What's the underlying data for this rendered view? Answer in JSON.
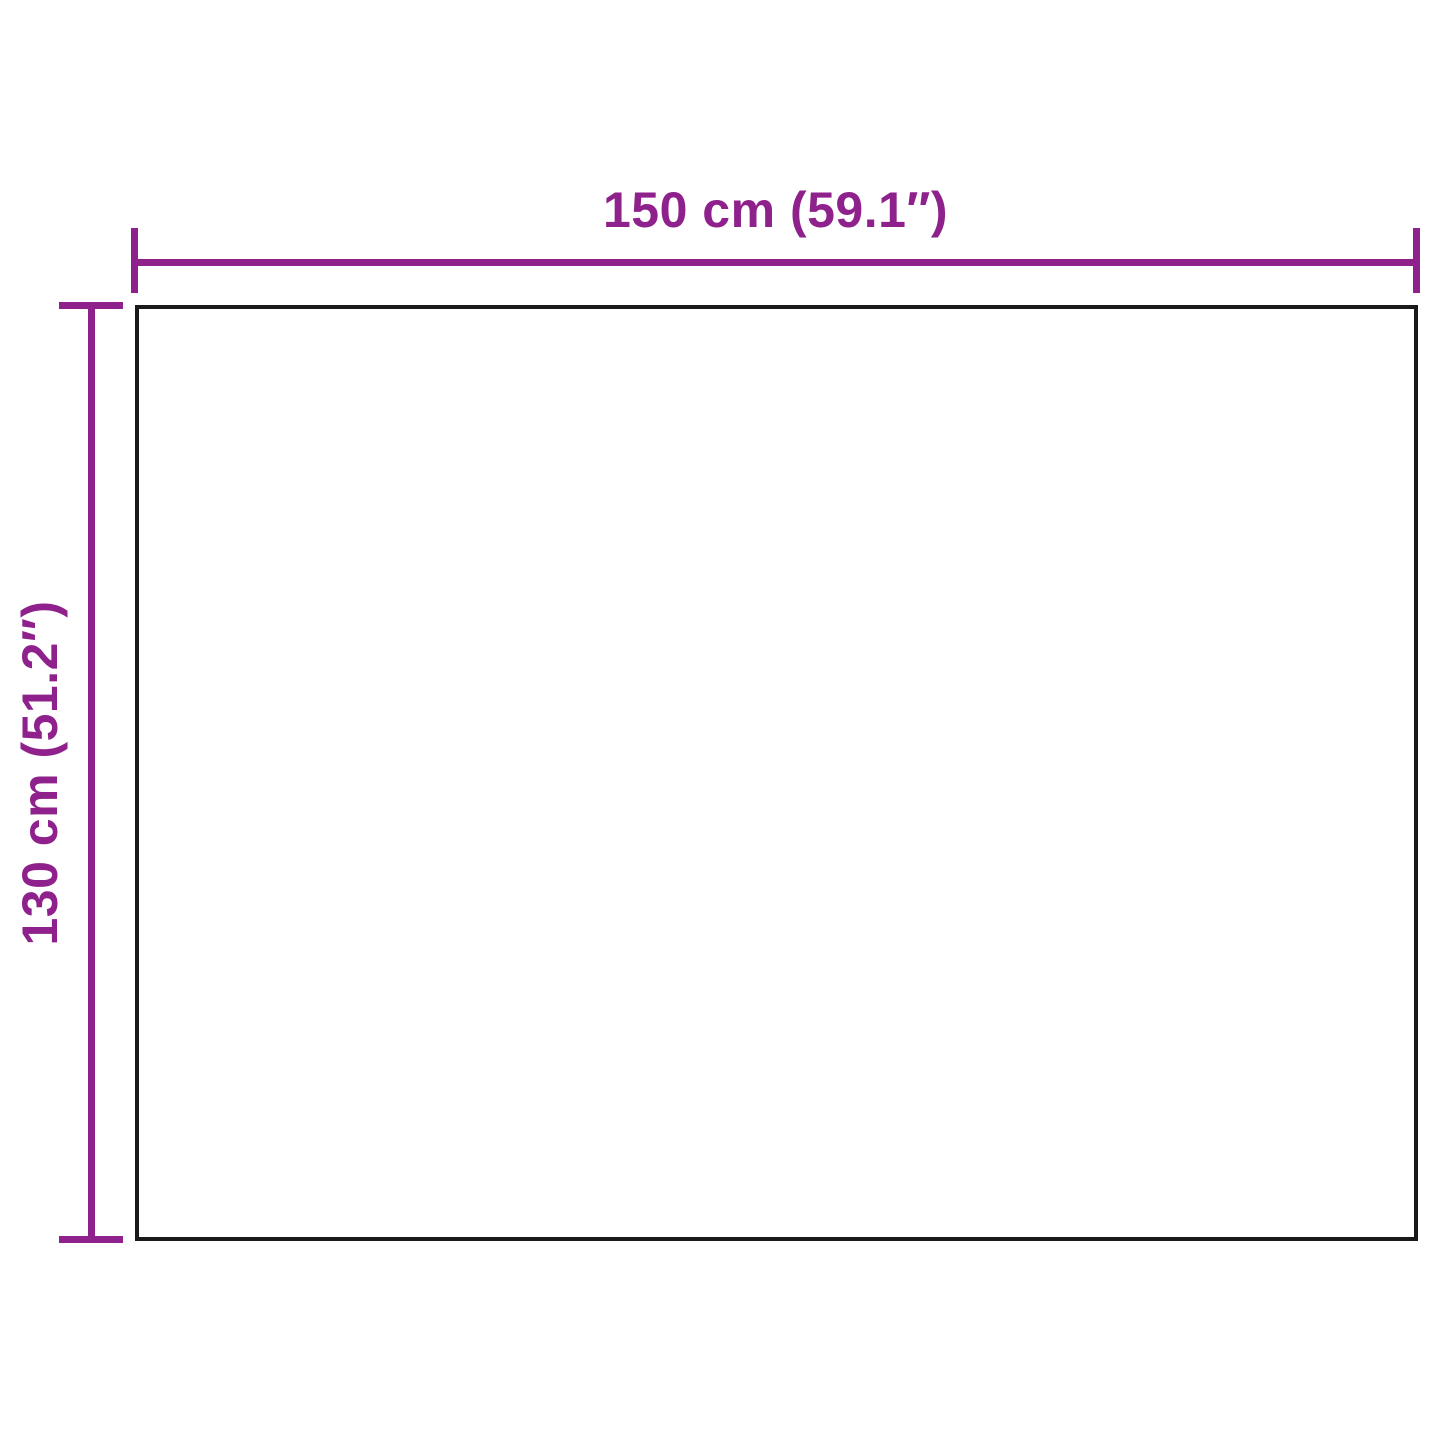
{
  "diagram": {
    "type": "product-dimension-diagram",
    "width_label": "150 cm (59.1″)",
    "height_label": "130 cm (51.2″)",
    "width_cm": 150,
    "width_inches": 59.1,
    "height_cm": 130,
    "height_inches": 51.2,
    "accent_color": "#8E218B",
    "outline_color": "#1A1A1A",
    "background_color": "#FFFFFF"
  }
}
